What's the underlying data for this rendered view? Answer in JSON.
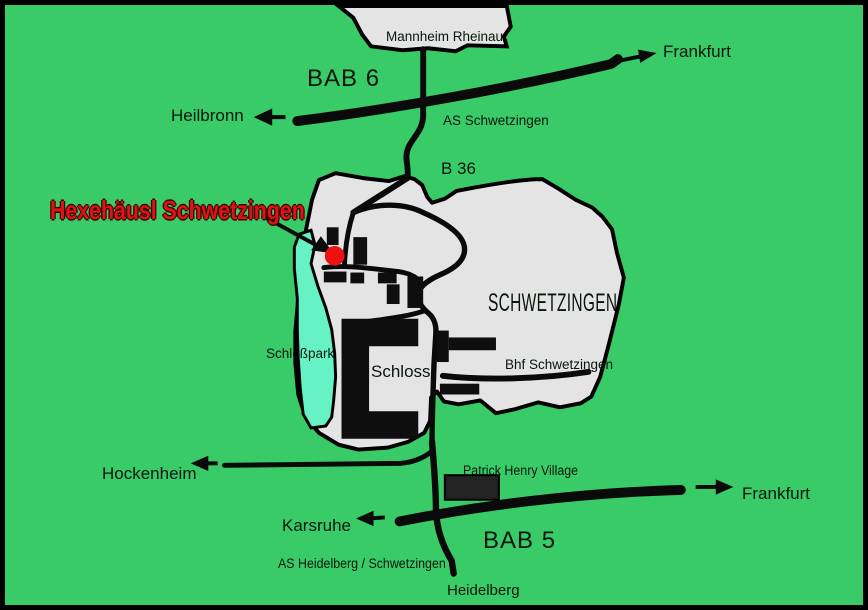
{
  "map": {
    "colors": {
      "background": "#38cb68",
      "land": "#e4e4e4",
      "park": "#66f2c4",
      "road": "#0a0a0a",
      "marker": "#ee1111",
      "destination_text": "#dd1414",
      "building": "#0e0e0e",
      "phv_building": "#232323"
    },
    "labels": {
      "mannheim_rheinau": "Mannheim Rheinau",
      "bab6": "BAB 6",
      "frankfurt_north": "Frankfurt",
      "heilbronn": "Heilbronn",
      "as_schwetzingen": "AS Schwetzingen",
      "b36": "B 36",
      "destination": "Hexehäusl Schwetzingen",
      "city": "SCHWETZINGEN",
      "schlosspark": "Schloßpark",
      "schloss": "Schloss",
      "bhf_schwetzingen": "Bhf Schwetzingen",
      "hockenheim": "Hockenheim",
      "patrick_henry_village": "Patrick Henry Village",
      "karsruhe": "Karsruhe",
      "bab5": "BAB 5",
      "frankfurt_south": "Frankfurt",
      "as_heidelberg": "AS Heidelberg / Schwetzingen",
      "heidelberg": "Heidelberg"
    }
  }
}
